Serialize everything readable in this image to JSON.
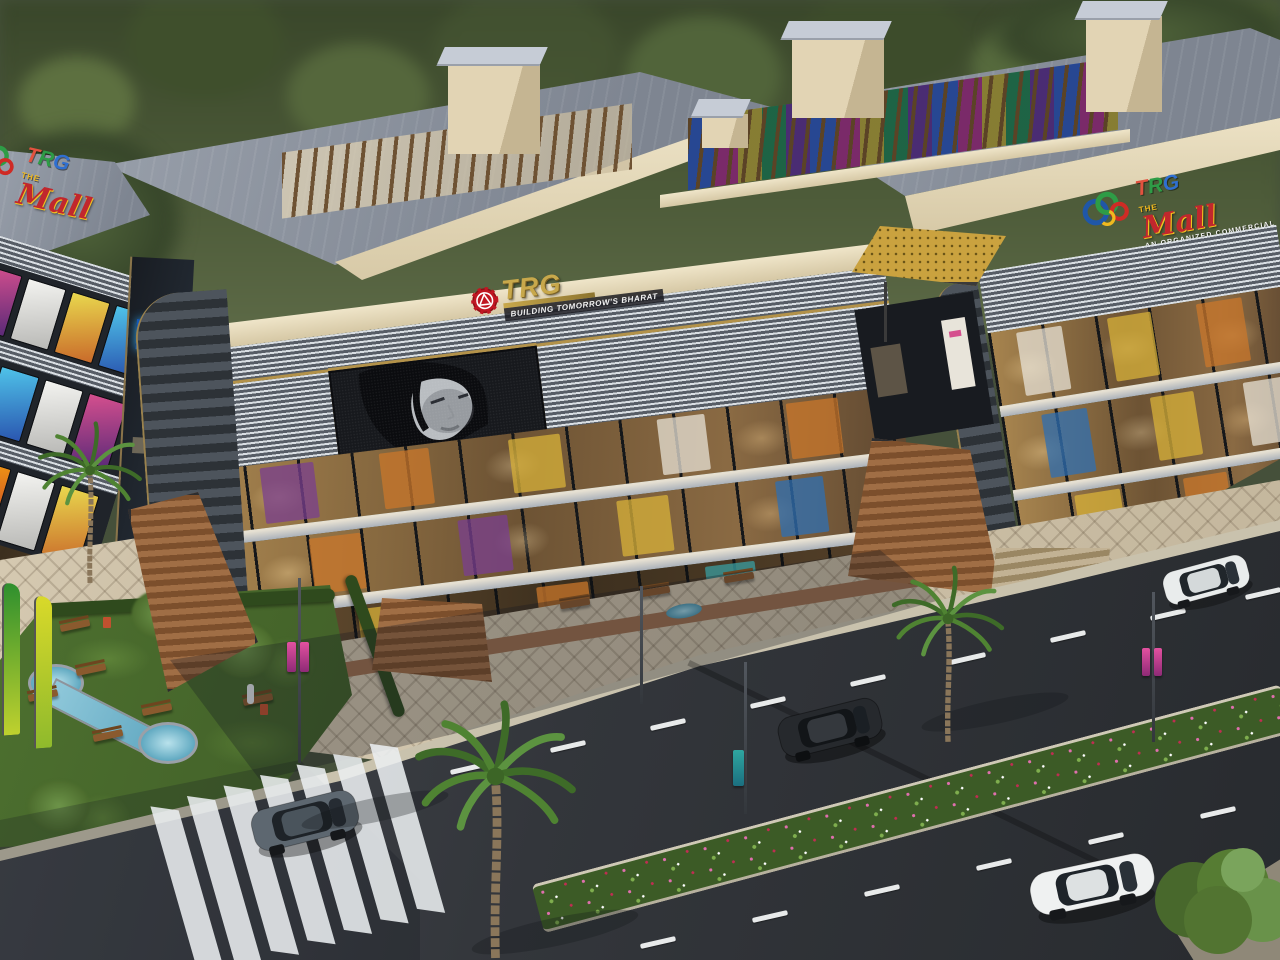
{
  "signage": {
    "building_sign": {
      "brand": "TRG",
      "tagline": "BUILDING TOMORROW'S BHARAT"
    },
    "mall_logo": {
      "letters": [
        {
          "ch": "T",
          "color": "#e2523f"
        },
        {
          "ch": "R",
          "color": "#2e9c46"
        },
        {
          "ch": "G",
          "color": "#2f6fd0"
        }
      ],
      "the": "THE",
      "mall": "Mall",
      "tagline": "AN ORGANIZED COMMERCIAL"
    }
  },
  "palette": {
    "building_cream": "#e7dcc0",
    "roof_gray": "#8b919c",
    "facade_dark": "#23262b",
    "glass_warm": "#c29a5e",
    "gold_accent": "#c9a44a",
    "brand_red_gear": "#c01722",
    "brand_gold": "#c8a84b",
    "mall_red": "#c1272d",
    "mall_green": "#2e9c46",
    "mall_blue": "#1f57a8",
    "mall_yellow": "#f0b91f",
    "road_asphalt": "#33363b",
    "plaza_paving": "#cdc1a9",
    "grass_green": "#4a6c2e",
    "canopy_gold": "#caa23f",
    "billboard_monochrome": "#b9bdc1"
  },
  "scene_objects": [
    "three-storey mall buildings with glass storefronts and louver bands",
    "curved corner LED billboard showing a woman's monochrome portrait",
    "gold perforated entrance canopy",
    "grand brown staircases to plaza",
    "patterned paving plaza",
    "landscaped garden with fountain canal, benches, trees and trash bins",
    "green and yellow feather flags",
    "street lamps with pink and teal ad banners",
    "asphalt road with dashed lane markings and zebra crosswalk",
    "flower median strip",
    "gray SUV, black SUV, white SUV, white sedan",
    "three palm trees and background forest"
  ]
}
